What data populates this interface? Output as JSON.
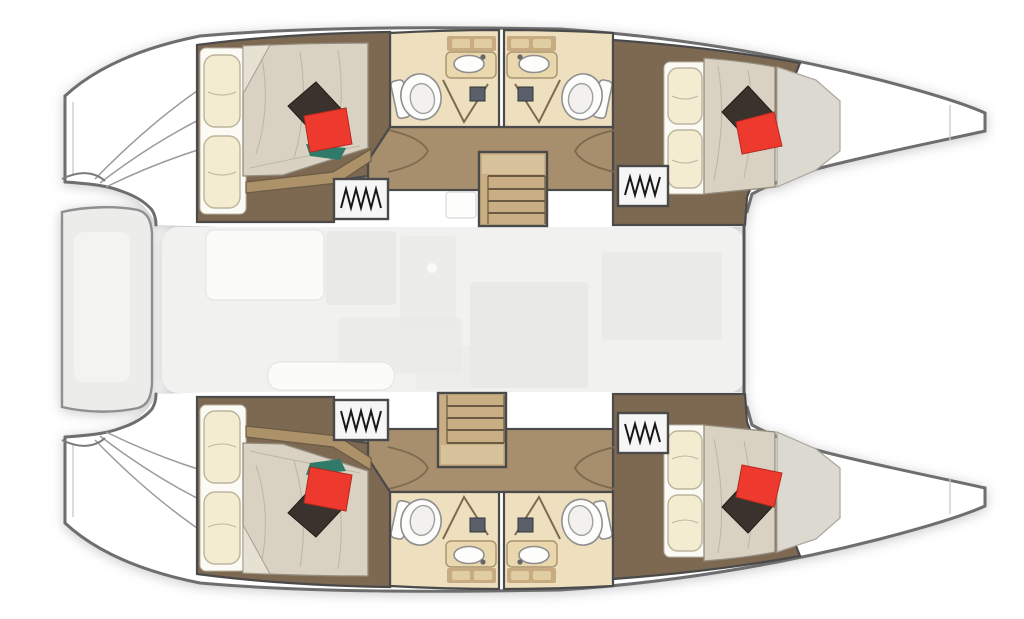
{
  "meta": {
    "title": "Catamaran yacht floor plan, top-down view",
    "description": "Layout drawing of a four-cabin sailing catamaran: two hulls each with two double-berth cabins and two bathrooms, twin staircases to a central saloon, boarding platforms with curved step lines at the left and tapered twin bows at the right."
  },
  "colors": {
    "page_bg": "#ffffff",
    "hull_fill": "#ffffff",
    "hull_outline": "#6e6e6e",
    "wall_dark": "#4a4a4a",
    "cabin_floor": "#7d6852",
    "corridor_floor": "#a78e6d",
    "bath_floor": "#eee0bf",
    "bath_counter": "#ead7ae",
    "counter_edge": "#a8946d",
    "backsplash": "#c8ab80",
    "fixture_white": "#fdfdfc",
    "fixture_outline": "#8f8f8f",
    "sheet_white": "#fbfaf4",
    "pillow_cream": "#f3ecd1",
    "pillow_edge": "#bcb49a",
    "mattress": "#d9d2c3",
    "mattress_shade": "#dcd9d1",
    "bed_wood": "#ac9169",
    "pillow_red": "#ee3a2e",
    "pillow_dark": "#3a332d",
    "pillow_teal": "#2f7a69",
    "wardrobe_bg": "#f6f6f6",
    "hanger_ink": "#171717",
    "door_line": "#7c6b50",
    "handle_dark": "#59606b",
    "stair_wood": "#c9ad83",
    "stair_landing": "#d8c29c",
    "stair_line": "#6a5a44",
    "saloon_bg": "#f1f1ef",
    "saloon_furniture": "#e9e9e7",
    "saloon_furniture_light": "#fbfbfa",
    "bench_fill": "#ececeb",
    "bench_edge": "#8f8f8f",
    "deck_line": "#c8c8c8",
    "stern_curve": "#9b9b9b"
  },
  "layout": {
    "hulls": [
      {
        "name": "upper-hull",
        "cabins": 2,
        "bathrooms": 2,
        "bow": "tapered point at right",
        "platform": "boarding platform with curved step lines at left"
      },
      {
        "name": "lower-hull",
        "cabins": 2,
        "bathrooms": 2,
        "bow": "tapered point at right",
        "platform": "boarding platform with curved step lines at left"
      }
    ],
    "cabins": [
      {
        "hull": "upper",
        "position": "left",
        "features": [
          "double berth",
          "two cream pillows",
          "dark accent pillow",
          "red accent pillow",
          "hanging locker"
        ]
      },
      {
        "hull": "upper",
        "position": "right",
        "features": [
          "double berth",
          "two cream pillows",
          "dark accent pillow",
          "red accent pillow",
          "hanging locker"
        ]
      },
      {
        "hull": "lower",
        "position": "left",
        "features": [
          "double berth",
          "two cream pillows",
          "dark accent pillow",
          "red accent pillow",
          "hanging locker"
        ]
      },
      {
        "hull": "lower",
        "position": "right",
        "features": [
          "double berth",
          "two cream pillows",
          "dark accent pillow",
          "red accent pillow",
          "hanging locker"
        ]
      }
    ],
    "bathrooms": [
      {
        "hull": "upper",
        "side": "left",
        "fixtures": [
          "toilet",
          "washbasin counter",
          "shower door",
          "entry door"
        ]
      },
      {
        "hull": "upper",
        "side": "right",
        "fixtures": [
          "toilet",
          "washbasin counter",
          "shower door",
          "entry door"
        ]
      },
      {
        "hull": "lower",
        "side": "left",
        "fixtures": [
          "toilet",
          "washbasin counter",
          "shower door",
          "entry door"
        ]
      },
      {
        "hull": "lower",
        "side": "right",
        "fixtures": [
          "toilet",
          "washbasin counter",
          "shower door",
          "entry door"
        ]
      }
    ],
    "stairs": [
      {
        "hull": "upper",
        "steps": 4,
        "connects": "hull corridor to saloon"
      },
      {
        "hull": "lower",
        "steps": 4,
        "connects": "hull corridor to saloon"
      }
    ],
    "saloon": {
      "description": "central bridge-deck area with faint galley, table and seating shapes",
      "right_boundary": "dark bulkhead line"
    },
    "cockpit_bench": {
      "position": "far left between hulls",
      "shape": "rounded vertical bench"
    }
  }
}
